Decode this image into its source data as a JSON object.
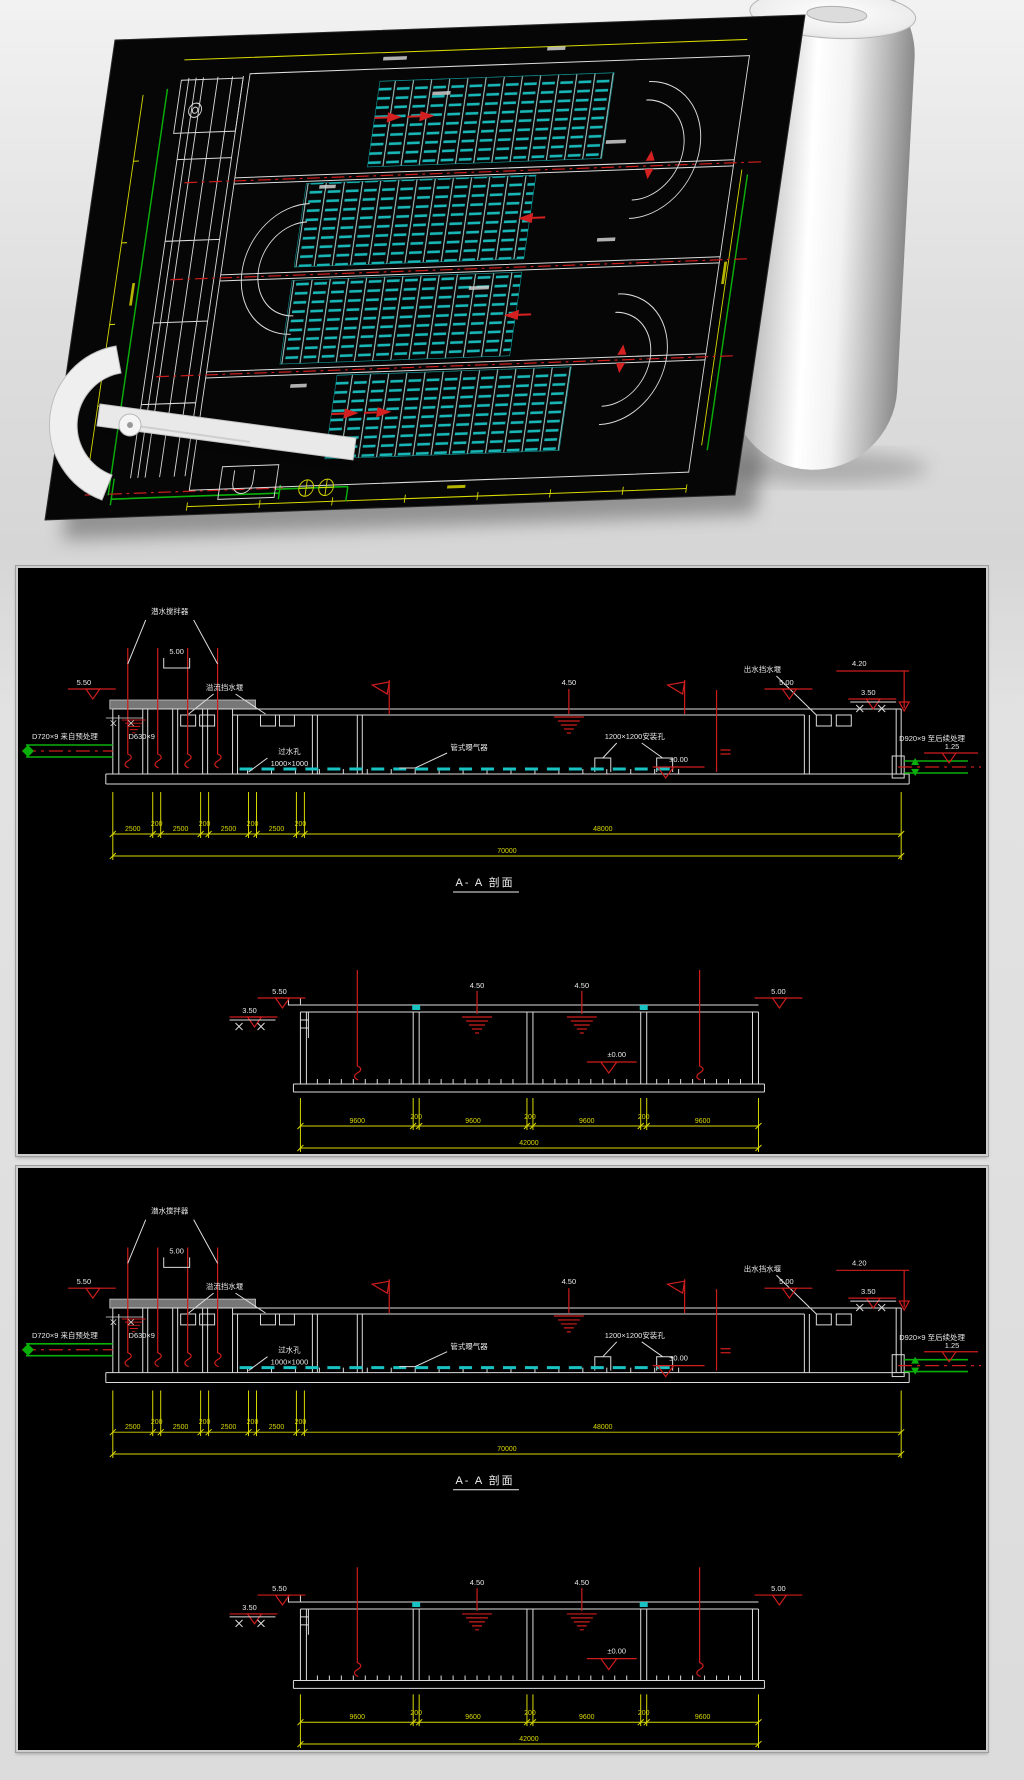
{
  "colors": {
    "cad_white": "#dcdcdc",
    "cad_yellow": "#d8d800",
    "cad_green": "#0ab00a",
    "cad_red": "#cf1d1d",
    "cad_cyan": "#19c3c3",
    "sheet_black": "#060606",
    "background_gray": "#dcdcdc"
  },
  "panel": {
    "section": {
      "title": "A- A 剖面",
      "labels": {
        "mixer": "潜水搅拌器",
        "weir_left": "溢流挡水堰",
        "hole_line1": "过水孔",
        "hole_line2": "1000×1000",
        "diffuser": "管式曝气器",
        "pit": "1200×1200安装孔",
        "weir_right": "出水挡水堰",
        "pipe_in": "D720×9 来自预处理",
        "pipe_in2": "D630×9",
        "pipe_out": "D920×9 至后续处理"
      },
      "elev": {
        "e550": "5.50",
        "e500": "5.00",
        "e450": "4.50",
        "e420": "4.20",
        "e350": "3.50",
        "e125": "1.25",
        "e000": "±0.00"
      },
      "dims": {
        "segments": [
          "2500",
          "200",
          "2500",
          "200",
          "2500",
          "200",
          "2500",
          "200"
        ],
        "mid": "48000",
        "total": "70000"
      }
    },
    "cross": {
      "elev": {
        "e550": "5.50",
        "e450": "4.50",
        "e500": "5.00",
        "e350": "3.50",
        "e000": "±0.00"
      },
      "dims": {
        "segments": [
          "9600",
          "200",
          "9600",
          "200",
          "9600",
          "200",
          "9600"
        ],
        "total": "42000"
      }
    }
  }
}
